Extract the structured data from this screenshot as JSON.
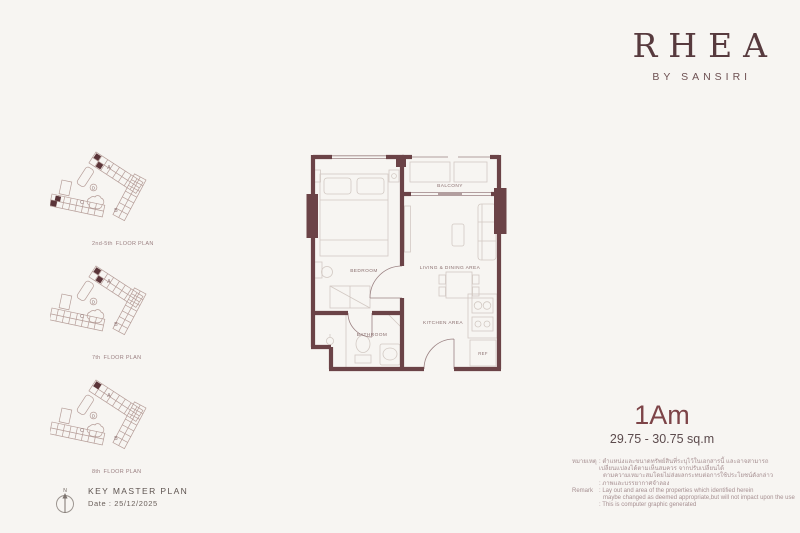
{
  "brand": {
    "name": "RHEA",
    "byline": "BY SANSIRI"
  },
  "key_plans": {
    "wing_labels": {
      "a": "A",
      "b": "B",
      "c": "C",
      "d": "D"
    },
    "plans": [
      {
        "floors": "2nd-5th",
        "label": "FLOOR PLAN"
      },
      {
        "floors": "7th",
        "label": "FLOOR PLAN"
      },
      {
        "floors": "8th",
        "label": "FLOOR PLAN"
      }
    ]
  },
  "floor_plan": {
    "rooms": {
      "bedroom": "BEDROOM",
      "living_dining": "LIVING & DINING AREA",
      "balcony": "BALCONY",
      "kitchen": "KITCHEN AREA",
      "bathroom": "BATHROOM",
      "refrigerator": "REF"
    }
  },
  "unit": {
    "type": "1Am",
    "area": "29.75 - 30.75 sq.m"
  },
  "key_master_plan": {
    "north": "N",
    "title": "KEY MASTER PLAN",
    "date": "Date : 25/12/2025"
  },
  "remark": {
    "th_label": "หมายเหตุ",
    "th_lines": [
      ": ตำแหน่งและขนาดทรัพย์สินที่ระบุไว้ในเอกสารนี้ และอาจสามารถเปลี่ยนแปลงได้ตามเห็นสมควร จากปรับเปลี่ยนได้",
      "ตามความเหมาะสมโดยไม่ส่งผลกระทบต่อการใช้ประโยชน์ดังกล่าว",
      ": ภาพและบรรยากาศจำลอง"
    ],
    "en_label": "Remark",
    "en_lines": [
      ": Lay out and area of the properties which identified herein",
      "maybe changed as deemed appropriate,but will not impact upon the use",
      ": This is computer graphic generated"
    ]
  },
  "colors": {
    "accent": "#5d3b3f",
    "wall": "#6b4347",
    "unit_mark": "#5a3438"
  }
}
